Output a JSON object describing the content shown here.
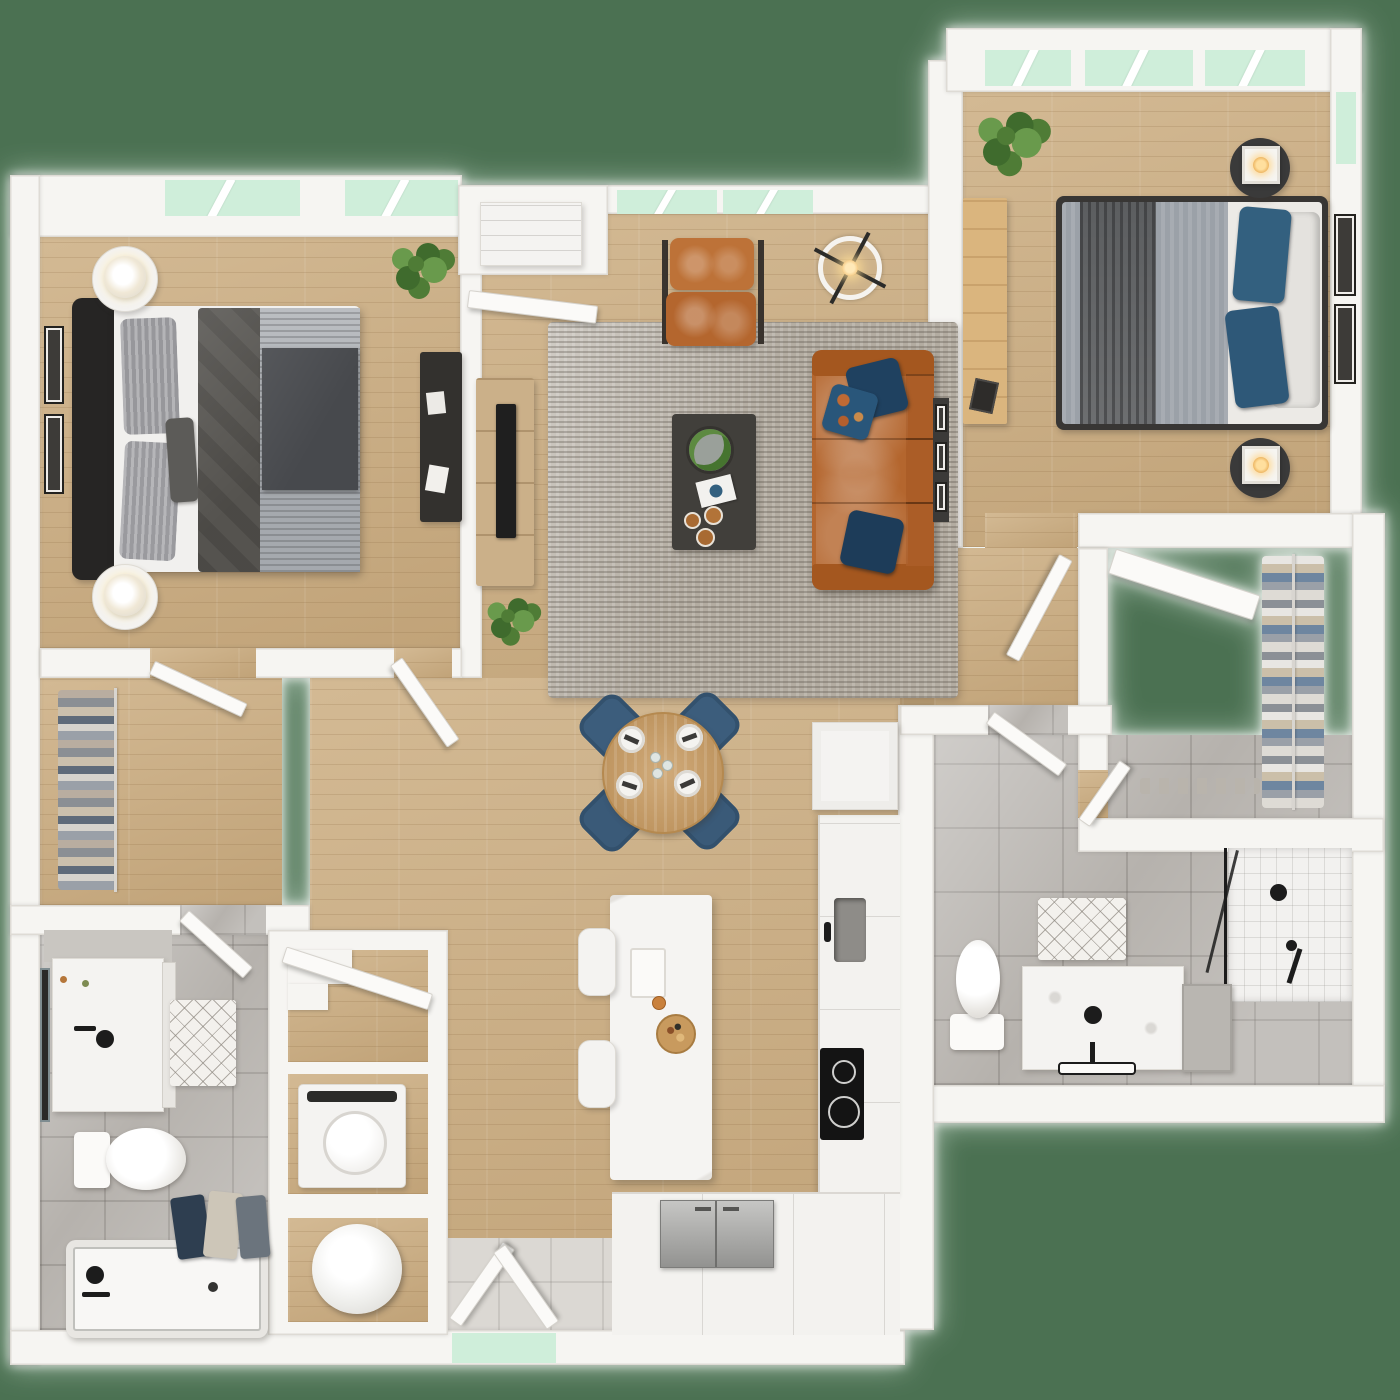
{
  "meta": {
    "title": "Two-bedroom, two-bath apartment 3D floor plan (top-down render)",
    "view": "top-down",
    "visible_text": "none"
  },
  "palette": {
    "background_green": "#4b7152",
    "window_mint": "#cfeeda",
    "wall_white": "#f6f5f2",
    "hardwood_tan": "#ccae82",
    "bath_tile_gray": "#b6b2ad",
    "entry_tile_gray": "#dbd8d3",
    "rug_gray": "#b3aca1",
    "sofa_leather_orange": "#b4662e",
    "pillow_navy": "#1f4160",
    "bedding_charcoal": "#55534f",
    "bedding_silver": "#a5a9ae",
    "counter_white": "#f3f2ef",
    "fixture_black": "#1c1c1c",
    "dining_chair_blue": "#3c5d7c",
    "table_wood": "#c89c63",
    "plant_green": "#4f7c36"
  },
  "rooms": [
    {
      "id": "bedroom-1",
      "name": "Bedroom 1",
      "floor": "hardwood",
      "furniture": [
        "platform bed with charcoal and silver bedding",
        "2 nightstands with round lamps",
        "dark desk",
        "2 wall art frames",
        "potted plant",
        "2 windows"
      ]
    },
    {
      "id": "living-room",
      "name": "Living Room",
      "floor": "hardwood",
      "furniture": [
        "gray area rug",
        "cognac leather sofa with navy pillows",
        "leather accent chair with ottoman",
        "dark coffee table with tray, magazine and cups",
        "media console with TV",
        "ring ceiling fan light",
        "floor plant",
        "entry closet with cabinet",
        "2 windows"
      ]
    },
    {
      "id": "dining-area",
      "name": "Dining Area",
      "floor": "hardwood",
      "furniture": [
        "round wood table",
        "4 blue upholstered chairs",
        "4 place settings with glassware"
      ]
    },
    {
      "id": "kitchen",
      "name": "Kitchen",
      "floor": "hardwood",
      "furniture": [
        "L-shaped white counter",
        "undermount sink",
        "black cooktop",
        "stainless refrigerator",
        "white island",
        "2 stools",
        "serving board",
        "pantry cabinet"
      ]
    },
    {
      "id": "bedroom-2",
      "name": "Bedroom 2",
      "floor": "hardwood",
      "furniture": [
        "bed with gray duvet and blue pillows",
        "2 round nightstands with cube lamps",
        "light wood desk",
        "2 wall art frames",
        "potted plant",
        "3 windows",
        "corner side window"
      ]
    },
    {
      "id": "walk-in-closet-1",
      "name": "Walk-in Closet 1",
      "floor": "hardwood",
      "furniture": [
        "hanging clothes rod",
        "hinged door"
      ]
    },
    {
      "id": "walk-in-closet-2",
      "name": "Walk-in Closet 2",
      "floor": "hardwood",
      "furniture": [
        "hanging clothes rod",
        "corner shelf",
        "shoe row",
        "hinged door"
      ]
    },
    {
      "id": "bathroom-1",
      "name": "Bathroom 1",
      "floor": "gray tile",
      "furniture": [
        "vanity with black faucet",
        "framed mirror",
        "diamond bath mat",
        "toilet",
        "bathtub with black fixtures",
        "towels",
        "hinged door"
      ]
    },
    {
      "id": "bathroom-2",
      "name": "Bathroom 2",
      "floor": "gray tile",
      "furniture": [
        "walk-in glass shower with black fixtures",
        "vanity with black sink",
        "gray side cabinet",
        "diamond bath mat",
        "toilet",
        "towel bar",
        "hinged door"
      ]
    },
    {
      "id": "laundry-closet",
      "name": "Laundry / Utility Closet",
      "furniture": [
        "top-load washer",
        "water heater",
        "open shelves",
        "leaning door"
      ]
    },
    {
      "id": "entry",
      "name": "Entry",
      "floor": "tile",
      "furniture": [
        "double entry doors"
      ]
    }
  ],
  "icons": [
    {
      "name": "window-gap",
      "meaning": "window opening showing mint background"
    },
    {
      "name": "door-leaf",
      "meaning": "open hinged door"
    }
  ]
}
